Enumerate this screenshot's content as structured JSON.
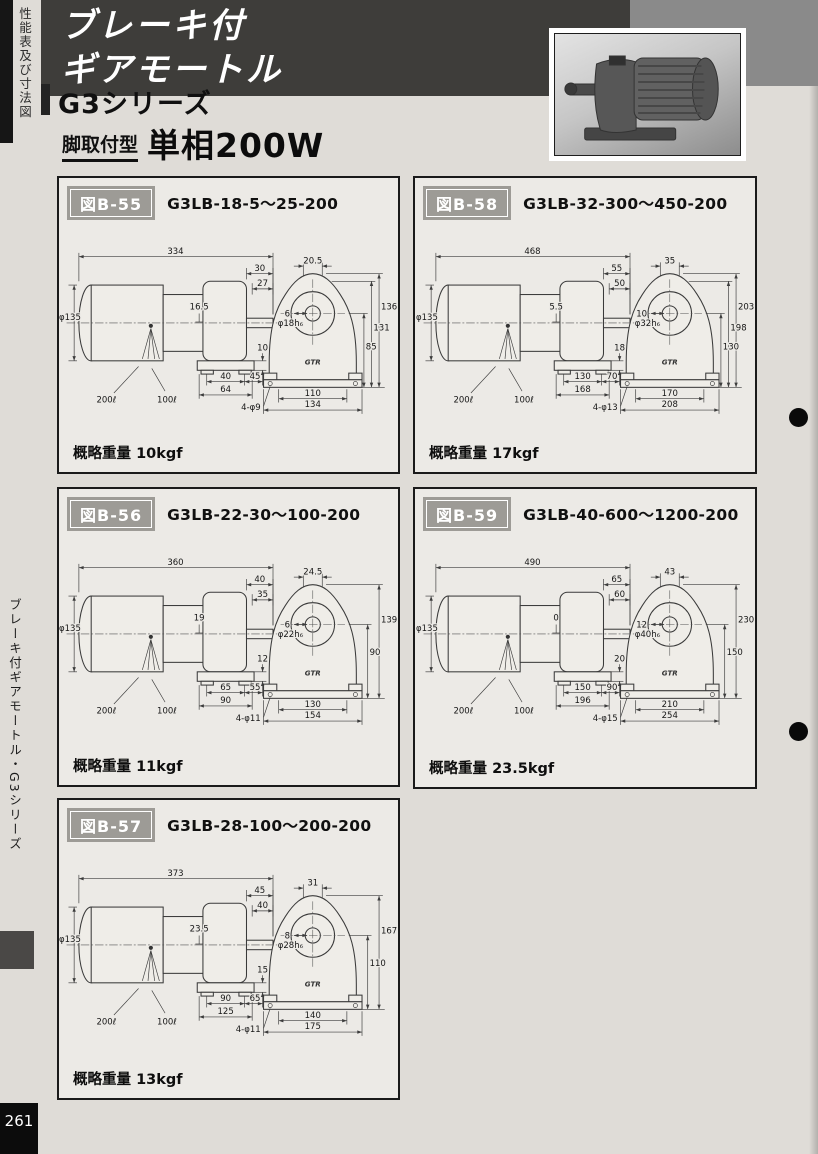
{
  "page": {
    "background": "#dfdcd7",
    "page_number": "261",
    "top_sidebar_vertical_text": "性能表及び寸法図",
    "left_sidebar_vertical_text": "ブレーキ付ギアモートル・G3シリーズ"
  },
  "header": {
    "title_line1": "ブレーキ付",
    "title_line2": "ギアモートル",
    "title_bg": "#3e3d3a",
    "series_label": "G3シリーズ",
    "mount_type_label": "脚取付型",
    "power_label": "単相200W",
    "photo_name": "gear-motor-product-photo"
  },
  "drawing": {
    "brand_mark": "GTR"
  },
  "figures": [
    {
      "fig_label": "図B-55",
      "model": "G3LB-18-5～25-200",
      "weight_label": "概略重量",
      "weight_value": "10kgf",
      "dims": {
        "overall": "334",
        "shaft_ext": "30",
        "shaft_len": "27",
        "offset": "16.5",
        "motor_dia": "φ135",
        "shaft_dia": "φ18h₆",
        "lead1": "200ℓ",
        "lead2": "100ℓ",
        "foot_h": "10",
        "foot_a": "40",
        "foot_c": "45",
        "foot_b": "64",
        "front_top": "20.5",
        "front_small": "6",
        "front_heights": [
          "136",
          "131",
          "85"
        ],
        "bolt": "4-φ9",
        "front_w1": "110",
        "front_w2": "134"
      }
    },
    {
      "fig_label": "図B-58",
      "model": "G3LB-32-300～450-200",
      "weight_label": "概略重量",
      "weight_value": "17kgf",
      "dims": {
        "overall": "468",
        "shaft_ext": "55",
        "shaft_len": "50",
        "offset": "5.5",
        "motor_dia": "φ135",
        "shaft_dia": "φ32h₆",
        "lead1": "200ℓ",
        "lead2": "100ℓ",
        "foot_h": "18",
        "foot_a": "130",
        "foot_c": "70",
        "foot_b": "168",
        "front_top": "35",
        "front_small": "10",
        "front_heights": [
          "203",
          "198",
          "130"
        ],
        "bolt": "4-φ13",
        "front_w1": "170",
        "front_w2": "208"
      }
    },
    {
      "fig_label": "図B-56",
      "model": "G3LB-22-30～100-200",
      "weight_label": "概略重量",
      "weight_value": "11kgf",
      "dims": {
        "overall": "360",
        "shaft_ext": "40",
        "shaft_len": "35",
        "offset": "19",
        "motor_dia": "φ135",
        "shaft_dia": "φ22h₆",
        "lead1": "200ℓ",
        "lead2": "100ℓ",
        "foot_h": "12",
        "foot_a": "65",
        "foot_c": "55",
        "foot_b": "90",
        "front_top": "24.5",
        "front_small": "6",
        "front_heights": [
          "139",
          "90"
        ],
        "bolt": "4-φ11",
        "front_w1": "130",
        "front_w2": "154"
      }
    },
    {
      "fig_label": "図B-59",
      "model": "G3LB-40-600～1200-200",
      "weight_label": "概略重量",
      "weight_value": "23.5kgf",
      "dims": {
        "overall": "490",
        "shaft_ext": "65",
        "shaft_len": "60",
        "offset": "0",
        "motor_dia": "φ135",
        "shaft_dia": "φ40h₆",
        "lead1": "200ℓ",
        "lead2": "100ℓ",
        "foot_h": "20",
        "foot_a": "150",
        "foot_c": "90",
        "foot_b": "196",
        "front_top": "43",
        "front_small": "12",
        "front_heights": [
          "230",
          "150"
        ],
        "bolt": "4-φ15",
        "front_w1": "210",
        "front_w2": "254"
      }
    },
    {
      "fig_label": "図B-57",
      "model": "G3LB-28-100～200-200",
      "weight_label": "概略重量",
      "weight_value": "13kgf",
      "dims": {
        "overall": "373",
        "shaft_ext": "45",
        "shaft_len": "40",
        "offset": "23.5",
        "motor_dia": "φ135",
        "shaft_dia": "φ28h₆",
        "lead1": "200ℓ",
        "lead2": "100ℓ",
        "foot_h": "15",
        "foot_a": "90",
        "foot_c": "65",
        "foot_b": "125",
        "front_top": "31",
        "front_small": "8",
        "front_heights": [
          "167",
          "110"
        ],
        "bolt": "4-φ11",
        "front_w1": "140",
        "front_w2": "175"
      }
    }
  ]
}
